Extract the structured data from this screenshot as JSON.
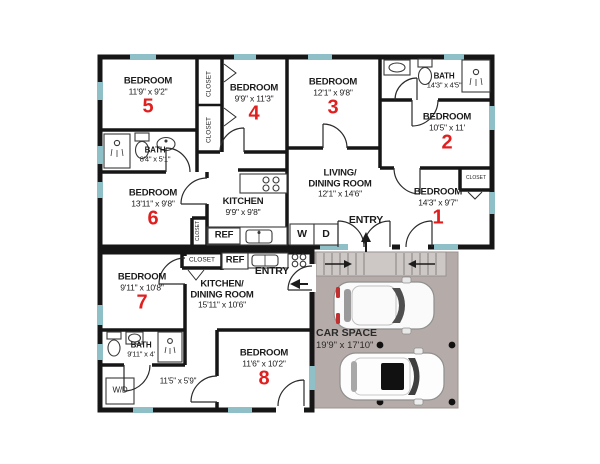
{
  "floor_plan": {
    "colors": {
      "wall": "#161616",
      "window": "#8fc0c8",
      "room_number": "#e01f1f",
      "car_space_fill": "#b5aca9",
      "stairs_fill": "#cdc8c6",
      "fixture_outline": "#3a3a3a"
    },
    "upper_unit": {
      "bedroom_5": {
        "label": "BEDROOM",
        "dims": "11'9\" x 9'2\"",
        "number": "5"
      },
      "bedroom_4": {
        "label": "BEDROOM",
        "dims": "9'9\" x 11'3\"",
        "number": "4"
      },
      "bedroom_3": {
        "label": "BEDROOM",
        "dims": "12'1\" x 9'8\"",
        "number": "3"
      },
      "bedroom_2": {
        "label": "BEDROOM",
        "dims": "10'5\" x 11'",
        "number": "2"
      },
      "bedroom_1": {
        "label": "BEDROOM",
        "dims": "14'3\" x 9'7\"",
        "number": "1"
      },
      "bedroom_6": {
        "label": "BEDROOM",
        "dims": "13'11\" x 9'8\"",
        "number": "6"
      },
      "bath_top": {
        "label": "BATH",
        "dims": "14'3\" x 4'5\""
      },
      "bath_left": {
        "label": "BATH",
        "dims": "8'4\" x 5'1\""
      },
      "kitchen": {
        "label": "KITCHEN",
        "dims": "9'9\" x 9'8\""
      },
      "living_dining": {
        "label_line1": "LIVING/",
        "label_line2": "DINING ROOM",
        "dims": "12'1\" x 14'6\""
      },
      "entry_label": "ENTRY",
      "washer_label": "W",
      "dryer_label": "D",
      "ref_label": "REF"
    },
    "lower_unit": {
      "bedroom_7": {
        "label": "BEDROOM",
        "dims": "9'11\" x 10'8\"",
        "number": "7"
      },
      "bedroom_8": {
        "label": "BEDROOM",
        "dims": "11'6\" x 10'2\"",
        "number": "8"
      },
      "bath": {
        "label": "BATH",
        "dims": "9'11\" x 4'"
      },
      "kitchen_dining": {
        "label_line1": "KITCHEN/",
        "label_line2": "DINING ROOM",
        "dims": "15'11\" x 10'6\""
      },
      "hall_dims": "11'5\" x 5'9\"",
      "entry_label": "ENTRY",
      "ref_label": "REF",
      "wd_label": "W/D"
    },
    "car_space": {
      "label": "CAR SPACE",
      "dims": "19'9\" x 17'10\""
    },
    "closet_label": "CLOSET"
  }
}
